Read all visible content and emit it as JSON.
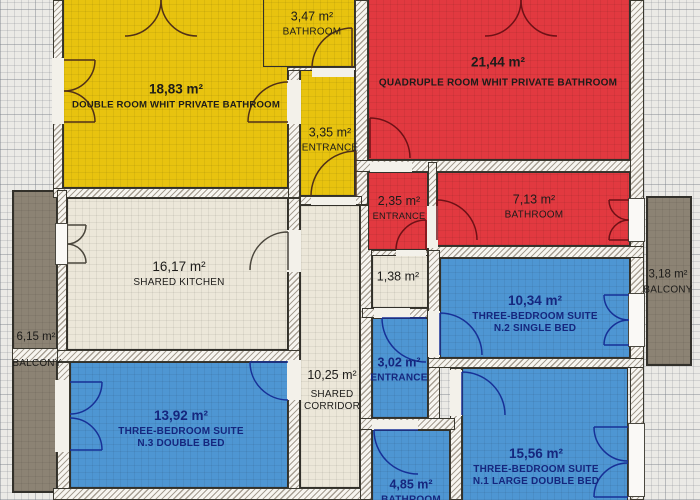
{
  "colors": {
    "yellow_room": "#e8c30f",
    "red_room": "#e23940",
    "blue_room": "#4e96d3",
    "cream_room": "#ece7d9",
    "balcony_gray": "#8c8374",
    "navy_text": "#15267e",
    "dark_text": "#1d1c1a"
  },
  "rooms": {
    "double_room": {
      "area": "18,83 m²",
      "name": "DOUBLE ROOM WHIT PRIVATE BATHROOM"
    },
    "bathroom_top": {
      "area": "3,47 m²",
      "name": "BATHROOM"
    },
    "entrance_top": {
      "area": "3,35 m²",
      "name": "ENTRANCE"
    },
    "quadruple_room": {
      "area": "21,44 m²",
      "name": "QUADRUPLE ROOM WHIT PRIVATE BATHROOM"
    },
    "entrance_mid": {
      "area": "2,35 m²",
      "name": "ENTRANCE"
    },
    "bathroom_mid": {
      "area": "7,13 m²",
      "name": "BATHROOM"
    },
    "shared_kitchen": {
      "area": "16,17 m²",
      "name": "SHARED KITCHEN"
    },
    "store_room": {
      "area": "1,38 m²",
      "name": ""
    },
    "suite_n2": {
      "area": "10,34 m²",
      "name": "THREE-BEDROOM SUITE",
      "sub": "N.2 SINGLE BED"
    },
    "balcony_right": {
      "area": "3,18 m²",
      "name": "BALCONY"
    },
    "balcony_left": {
      "area": "6,15 m²",
      "name": "BALCONY"
    },
    "suite_n3": {
      "area": "13,92 m²",
      "name": "THREE-BEDROOM SUITE",
      "sub": "N.3 DOUBLE BED"
    },
    "corridor": {
      "area": "10,25 m²",
      "name": "SHARED CORRIDOR"
    },
    "entrance_low": {
      "area": "3,02 m²",
      "name": "ENTRANCE"
    },
    "bathroom_low": {
      "area": "4,85 m²",
      "name": "BATHROOM"
    },
    "suite_n1": {
      "area": "15,56 m²",
      "name": "THREE-BEDROOM SUITE",
      "sub": "N.1 LARGE DOUBLE BED"
    }
  }
}
